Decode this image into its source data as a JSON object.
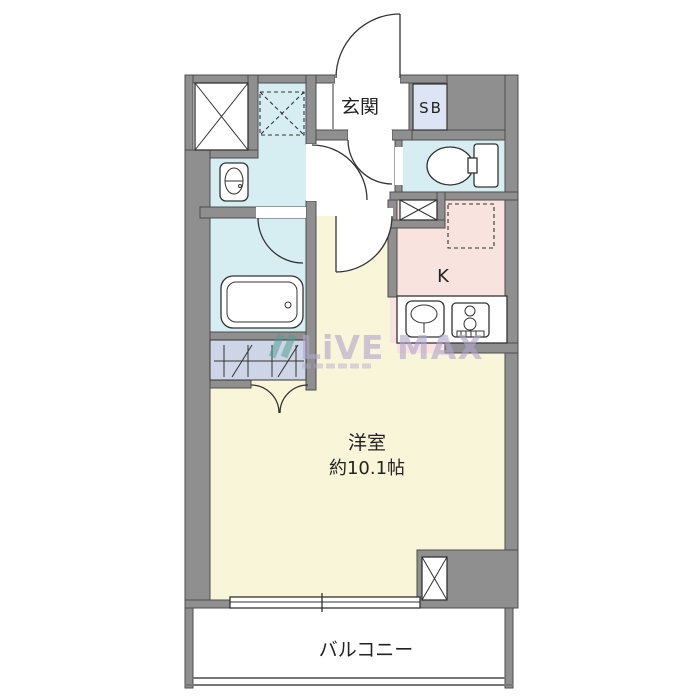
{
  "plan": {
    "entrance_label": "玄関",
    "shoe_box_label": "SB",
    "kitchen_label": "K",
    "main_room_label": "洋室",
    "main_room_size": "約10.1帖",
    "balcony_label": "バルコニー"
  },
  "watermark": {
    "text": "LiVE MAX"
  },
  "colors": {
    "wall": "#8f8f8f",
    "wall-edge": "#4d4d4d",
    "line": "#333333",
    "wet-room": "#d6eef2",
    "kitchen": "#f9e3df",
    "living": "#f9f5d8",
    "closet": "#cdd5e6",
    "shoe-box": "#dde4f4",
    "watermark": "#b1a7cd",
    "watermark-mark": "#4a9e8f",
    "text": "#222222"
  }
}
